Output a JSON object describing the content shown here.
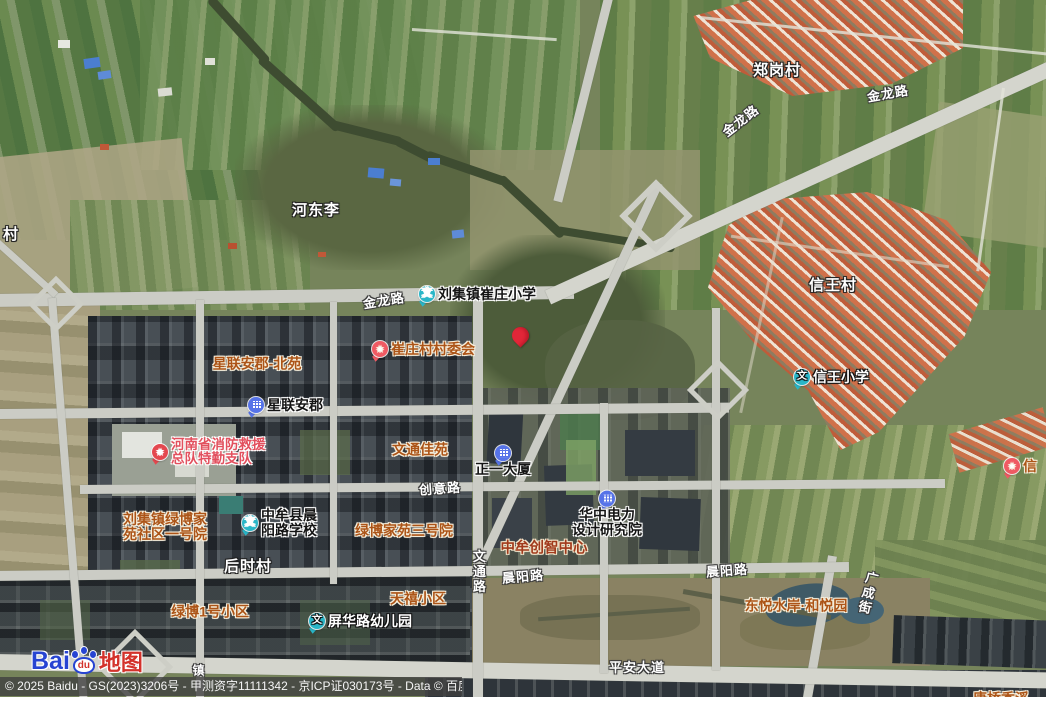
{
  "map": {
    "attribution": "© 2025 Baidu - GS(2023)3206号 - 甲测资字11111342 - 京ICP证030173号 - Data © 百度智图",
    "logo": {
      "bai": "Bai",
      "du": "du",
      "map_word": "地图"
    },
    "pin": {
      "x": 512,
      "y": 327,
      "color": "#e22638"
    },
    "colors": {
      "school_icon": "#29b6c8",
      "building_icon": "#5673e8",
      "star_icon": "#ef5a63",
      "gov_icon": "#e4484f",
      "pin": "#e22638",
      "orange_label": "#ac5417",
      "red_label": "#e2505e",
      "darkred_label": "#a13a1c"
    },
    "icon_glyphs": {
      "school": "文",
      "star": "★",
      "gov": "★",
      "building": ""
    },
    "labels": [
      {
        "id": "village-zhenggangcun",
        "type": "village",
        "text": "郑岗村",
        "x": 777,
        "y": 71,
        "interactable": false
      },
      {
        "id": "village-hedongli",
        "type": "village",
        "text": "河东李",
        "x": 316,
        "y": 211,
        "interactable": false
      },
      {
        "id": "village-xinwangcun",
        "type": "village",
        "text": "信王村",
        "x": 833,
        "y": 286,
        "interactable": false
      },
      {
        "id": "village-houshicun",
        "type": "village",
        "text": "后时村",
        "x": 248,
        "y": 567,
        "interactable": false
      },
      {
        "id": "village-partial-cun",
        "type": "village",
        "text": "村",
        "x": 11,
        "y": 235,
        "interactable": false
      },
      {
        "id": "road-jinlonglu-diagonal",
        "type": "road",
        "text": "金龙路",
        "x": 741,
        "y": 121,
        "rotate": -38,
        "interactable": false
      },
      {
        "id": "road-jinlonglu-east",
        "type": "road",
        "text": "金龙路",
        "x": 888,
        "y": 94,
        "rotate": -10,
        "interactable": false
      },
      {
        "id": "road-jinlonglu-west",
        "type": "road",
        "text": "金龙路",
        "x": 384,
        "y": 301,
        "rotate": -9,
        "interactable": false
      },
      {
        "id": "road-chuangyilu",
        "type": "road",
        "text": "创意路",
        "x": 440,
        "y": 489,
        "rotate": -4,
        "interactable": false
      },
      {
        "id": "road-chenyanglu-center",
        "type": "road",
        "text": "晨阳路",
        "x": 523,
        "y": 577,
        "rotate": -5,
        "interactable": false
      },
      {
        "id": "road-chenyanglu-east",
        "type": "road",
        "text": "晨阳路",
        "x": 727,
        "y": 571,
        "rotate": -4,
        "interactable": false
      },
      {
        "id": "road-wentonglu",
        "type": "road",
        "text": "文通路",
        "x": 478,
        "y": 572,
        "vertical": true,
        "interactable": false
      },
      {
        "id": "road-guangchengjie",
        "type": "road",
        "text": "广成街",
        "x": 867,
        "y": 593,
        "vertical": true,
        "rotate": 13,
        "interactable": false
      },
      {
        "id": "road-pingandadao",
        "type": "road",
        "text": "平安大道",
        "x": 637,
        "y": 668,
        "interactable": false
      },
      {
        "id": "road-partial-zhen",
        "type": "road",
        "text": "镇",
        "x": 199,
        "y": 671,
        "fs": 12,
        "interactable": false
      },
      {
        "id": "poi-liujizhen-cuizhuang-xiaoxue",
        "type": "poi",
        "icon": "school",
        "text": "刘集镇崔庄小学",
        "x": 419,
        "y": 286,
        "anchor": "left",
        "interactable": true
      },
      {
        "id": "poi-xinglian-anjun",
        "type": "poi",
        "icon": "building",
        "text": "星联安郡",
        "x": 248,
        "y": 397,
        "anchor": "left",
        "interactable": true
      },
      {
        "id": "poi-zhengyi-dasha",
        "type": "poi",
        "icon": "building",
        "text": "正一大厦",
        "x": 503,
        "y": 461,
        "column": true,
        "interactable": true
      },
      {
        "id": "poi-huazhong-dianli-sheji-yanjiuyuan",
        "type": "poi",
        "icon": "building",
        "lines": [
          "华中电力",
          "设计研究院"
        ],
        "x": 607,
        "y": 514,
        "column": true,
        "interactable": true
      },
      {
        "id": "poi-zhongmouxian-chenyanglu-xuexiao",
        "type": "poi",
        "icon": "school",
        "lines": [
          "中牟县晨",
          "阳路学校"
        ],
        "x": 242,
        "y": 508,
        "anchor": "left",
        "interactable": true
      },
      {
        "id": "poi-xinwang-xiaoxue",
        "type": "poi-light",
        "icon": "school",
        "text": "信王小学",
        "x": 794,
        "y": 369,
        "anchor": "left",
        "interactable": true
      },
      {
        "id": "poi-pinghualu-youeryuan",
        "type": "poi-light",
        "icon": "school",
        "text": "屏华路幼儿园",
        "x": 309,
        "y": 613,
        "anchor": "left",
        "interactable": true
      },
      {
        "id": "poi-xinglian-anjun-beiyuan",
        "type": "orange",
        "text": "星联安郡-北苑",
        "x": 257,
        "y": 364,
        "interactable": true
      },
      {
        "id": "poi-cuizhuangcun-cunweihui",
        "type": "orange",
        "icon": "star",
        "text": "崔庄村村委会",
        "x": 372,
        "y": 341,
        "anchor": "left",
        "interactable": true
      },
      {
        "id": "poi-wentong-jiayuan",
        "type": "orange",
        "text": "文通佳苑",
        "x": 420,
        "y": 450,
        "interactable": true
      },
      {
        "id": "poi-liujizhen-lvbojiayuan-yihaoyuan",
        "type": "orange",
        "lines": [
          "刘集镇绿博家",
          "苑社区一号院"
        ],
        "x": 165,
        "y": 527,
        "interactable": true
      },
      {
        "id": "poi-lvbojiayuan-sanhaoyuan",
        "type": "orange",
        "text": "绿博家苑三号院",
        "x": 404,
        "y": 531,
        "interactable": true
      },
      {
        "id": "poi-lvbo-1hao-xiaoqu",
        "type": "orange",
        "text": "绿博1号小区",
        "x": 210,
        "y": 612,
        "interactable": true
      },
      {
        "id": "poi-tianxi-xiaoqu",
        "type": "orange",
        "text": "天禧小区",
        "x": 418,
        "y": 599,
        "interactable": true
      },
      {
        "id": "poi-dongyue-shuian-heyueyuan",
        "type": "orange",
        "text": "东悦水岸·和悦园",
        "x": 796,
        "y": 606,
        "interactable": true
      },
      {
        "id": "poi-partial-tangqiao",
        "type": "orange",
        "text": "唐桥香溪",
        "x": 1001,
        "y": 699,
        "interactable": true
      },
      {
        "id": "poi-partial-xin",
        "type": "orange",
        "icon": "star",
        "text": "信",
        "x": 1004,
        "y": 458,
        "anchor": "left",
        "interactable": true
      },
      {
        "id": "poi-henansheng-xiaofang-jiuyuan",
        "type": "red",
        "icon": "gov",
        "lines": [
          "河南省消防救援",
          "总队特勤支队"
        ],
        "x": 152,
        "y": 438,
        "anchor": "left",
        "interactable": true
      },
      {
        "id": "poi-zhongmou-chuangzhi-zhongxin",
        "type": "darkred",
        "text": "中牟创智中心",
        "x": 544,
        "y": 549,
        "interactable": true
      }
    ]
  }
}
